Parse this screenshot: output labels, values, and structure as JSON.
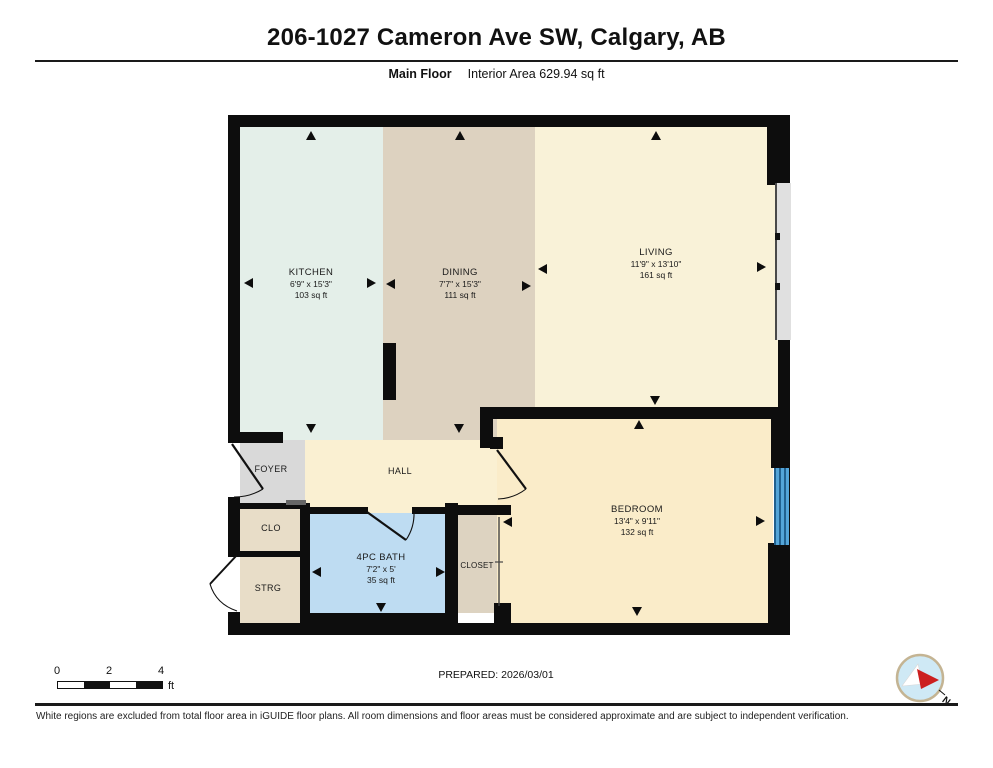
{
  "header": {
    "title": "206-1027 Cameron Ave SW, Calgary, AB",
    "floor_label": "Main Floor",
    "interior_area": "Interior Area 629.94 sq ft"
  },
  "rooms": {
    "kitchen": {
      "name": "KITCHEN",
      "dims": "6'9\" x 15'3\"",
      "area": "103 sq ft",
      "color": "#e4efe9"
    },
    "dining": {
      "name": "DINING",
      "dims": "7'7\" x 15'3\"",
      "area": "111 sq ft",
      "color": "#ddd2c0"
    },
    "living": {
      "name": "LIVING",
      "dims": "11'9\" x 13'10\"",
      "area": "161 sq ft",
      "color": "#f9f2d8"
    },
    "bedroom": {
      "name": "BEDROOM",
      "dims": "13'4\" x 9'11\"",
      "area": "132 sq ft",
      "color": "#faecc9"
    },
    "bath": {
      "name": "4PC BATH",
      "dims": "7'2\" x 5'",
      "area": "35 sq ft",
      "color": "#bedcf2"
    },
    "hall": {
      "name": "HALL",
      "color": "#faf0d2"
    },
    "foyer": {
      "name": "FOYER",
      "color": "#d9d9d9"
    },
    "clo": {
      "name": "CLO",
      "color": "#e8ddc8"
    },
    "strg": {
      "name": "STRG",
      "color": "#e8ddc8"
    },
    "closet": {
      "name": "CLOSET",
      "color": "#ddd3c1"
    }
  },
  "floorplan": {
    "wall_color": "#0d0d0d",
    "window_color": "#54a5d8",
    "compass": {
      "north_label": "N"
    }
  },
  "footer": {
    "scale": {
      "ticks": [
        "0",
        "2",
        "4"
      ],
      "unit": "ft"
    },
    "prepared": "PREPARED: 2026/03/01",
    "disclaimer": "White regions are excluded from total floor area in iGUIDE floor plans. All room dimensions and floor areas must be considered approximate and are subject to independent verification."
  }
}
